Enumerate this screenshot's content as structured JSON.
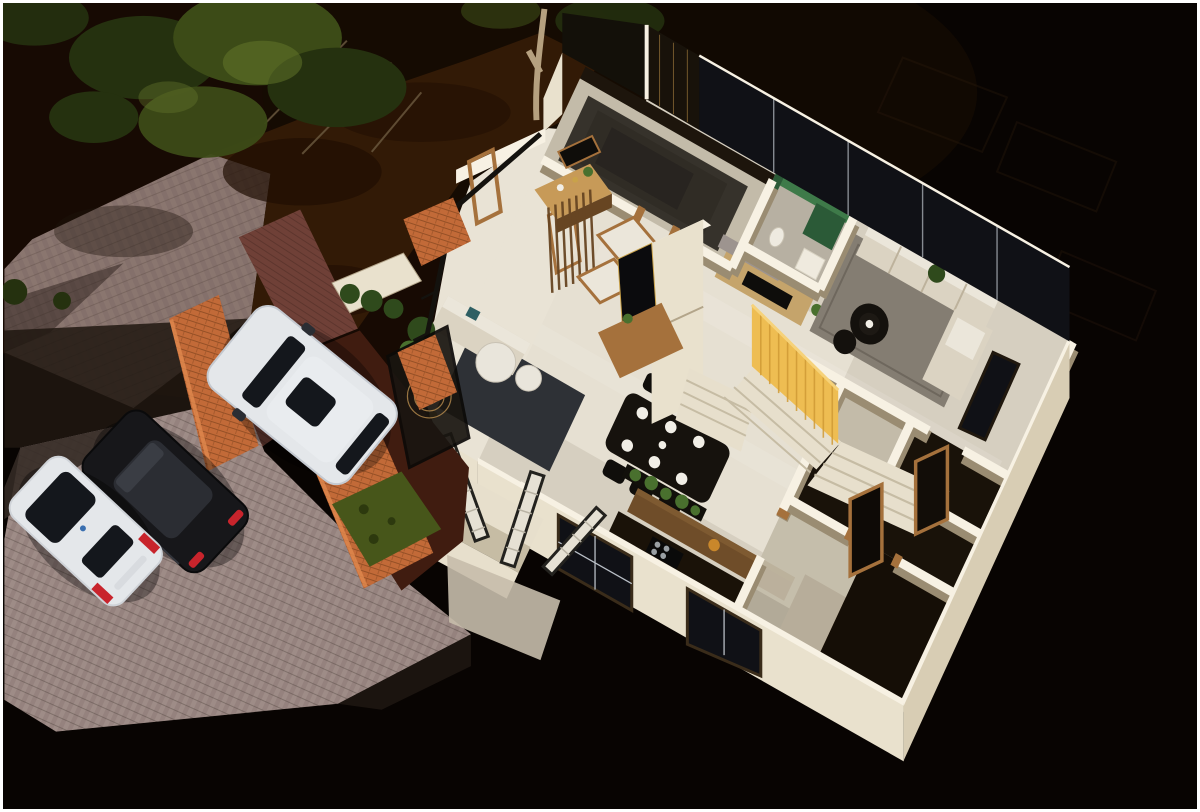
{
  "scene": {
    "type": "isometric 3D floor plan night render of a residence",
    "rooms": [
      "entry-veranda",
      "foyer",
      "master-bedroom",
      "ensuite-bathroom",
      "drawing-room",
      "family-living-room",
      "dining-area",
      "kitchen",
      "staircase",
      "utility-rooms",
      "carport",
      "front-porch"
    ],
    "vehicles": [
      "white-suv",
      "black-sedan",
      "white-hatchback"
    ],
    "landscape": [
      "street-paving",
      "garden-bed",
      "trees",
      "parking-apron",
      "brick-pathway",
      "lawn-patch",
      "planter-hedge"
    ]
  },
  "palette": {
    "bg": "#080402",
    "dirt": "#321a06",
    "dirt2": "#200e03",
    "street": "#84706b",
    "apron": "#95827e",
    "apronHi": "#a5938e",
    "apronSh": "#342a25",
    "brickPath": "#6f4037",
    "carport": "#401c10",
    "brick": "#c26a38",
    "brickHi": "#e0894e",
    "brickLn": "#8a4a22",
    "tree": "#3c4b17",
    "tree2": "#25310f",
    "tree3": "#66792c",
    "trunk": "#b5a07f",
    "lawn": "#47561a",
    "lawn2": "#2d390e",
    "wallTop": "#f7f1e3",
    "wall": "#e9e1cd",
    "wallMid": "#d8cdb4",
    "wallSh": "#b3a58a",
    "floor": "#d6cfc0",
    "floorHi": "#e9e3d5",
    "floorDim": "#c3bba9",
    "dark": "#191209",
    "glass": "#101116",
    "mull": "#b9bfc6",
    "rugFam": "#847d72",
    "rugBed": "#36322b",
    "rugDrw": "#2e3136",
    "sofa": "#dbd3c2",
    "cush": "#ebe6da",
    "sofaSh": "#bdb29c",
    "teal": "#2e5f63",
    "tblBlack": "#16120d",
    "plate": "#f1eee6",
    "wood": "#a5713c",
    "wood2": "#c79a58",
    "wood3": "#674522",
    "yellow": "#eebd52",
    "yellow2": "#d09a35",
    "tan": "#c5a46b",
    "ledge": "#9d948f",
    "green": "#3e7a49",
    "green2": "#2b5a37",
    "granite": "#1a1208",
    "island": "#6f4d29",
    "marbleT": "#e9e5db",
    "stair": "#e7dfcc",
    "stairSh": "#c6bca4",
    "carW": "#e4e7ea",
    "carWS": "#c4c9d0",
    "carG": "#14171c",
    "carB": "#17171a",
    "carBHi": "#33353c",
    "red": "#c8242c",
    "plant": "#49702e",
    "plant2": "#2f4a1c",
    "gold": "#c9a24a"
  }
}
